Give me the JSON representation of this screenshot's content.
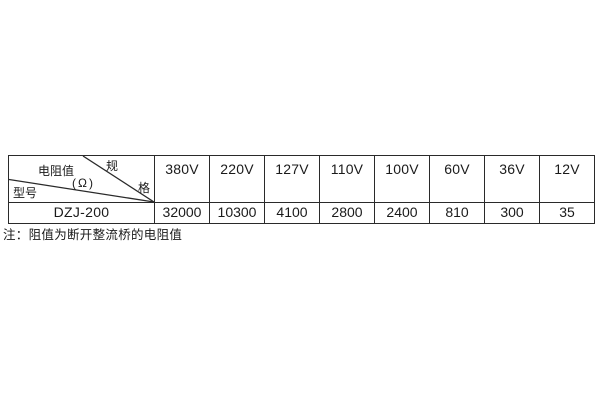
{
  "page": {
    "background": "#ffffff"
  },
  "colors": {
    "border": "#2a2a2a",
    "text": "#1a1a1a"
  },
  "spec_table": {
    "corner": {
      "spec_top": "规",
      "spec_bottom": "格",
      "resistance_label": "电阻值",
      "resistance_unit": "(Ω)",
      "model_label": "型号"
    },
    "voltage_columns": [
      "380V",
      "220V",
      "127V",
      "110V",
      "100V",
      "60V",
      "36V",
      "12V"
    ],
    "rows": [
      {
        "model": "DZJ-200",
        "values": [
          "32000",
          "10300",
          "4100",
          "2800",
          "2400",
          "810",
          "300",
          "35"
        ]
      }
    ]
  },
  "note": {
    "text": "注：阻值为断开整流桥的电阻值"
  }
}
